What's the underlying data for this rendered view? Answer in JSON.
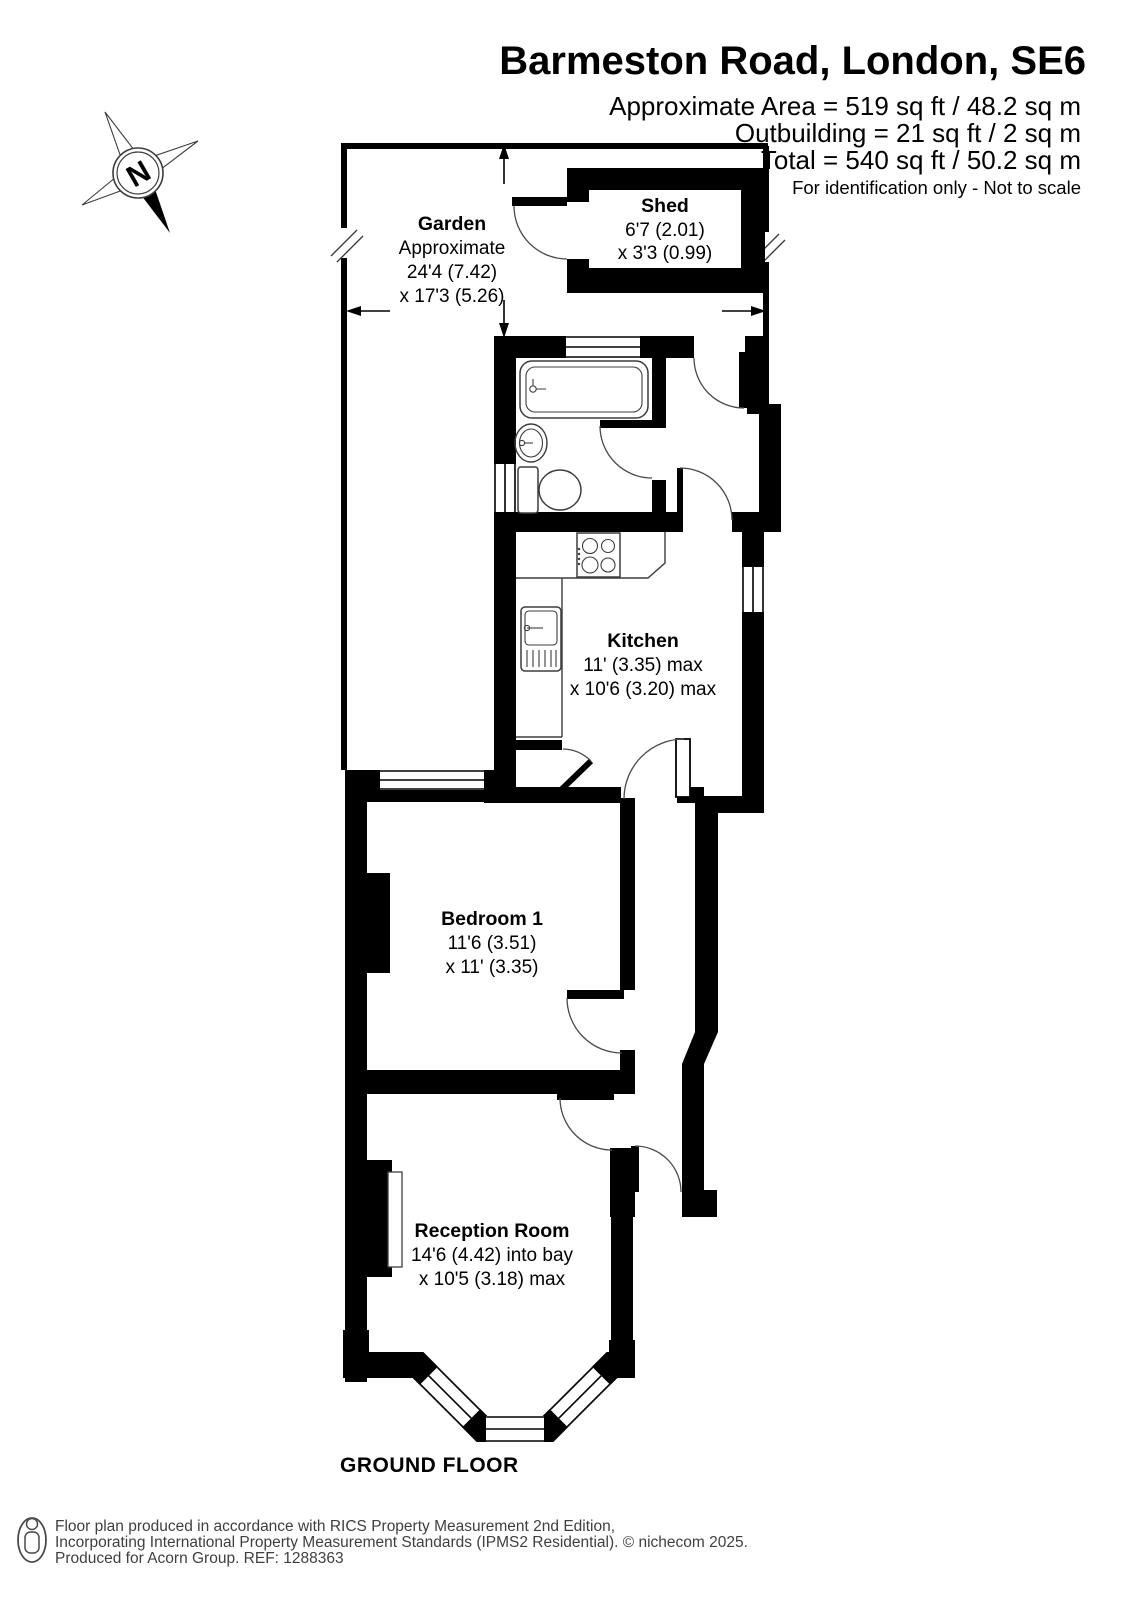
{
  "header": {
    "title": "Barmeston Road, London, SE6",
    "line1": "Approximate Area = 519 sq ft / 48.2 sq m",
    "line2": "Outbuilding = 21 sq ft / 2 sq m",
    "line3": "Total = 540 sq ft / 50.2 sq m",
    "disclaimer": "For identification only - Not to scale"
  },
  "compass": {
    "north_label": "N"
  },
  "rooms": {
    "garden": {
      "name": "Garden",
      "l1": "Approximate",
      "l2": "24'4 (7.42)",
      "l3": "x 17'3 (5.26)"
    },
    "shed": {
      "name": "Shed",
      "l1": "6'7 (2.01)",
      "l2": "x 3'3 (0.99)"
    },
    "kitchen": {
      "name": "Kitchen",
      "l1": "11' (3.35) max",
      "l2": "x 10'6 (3.20) max"
    },
    "bedroom": {
      "name": "Bedroom 1",
      "l1": "11'6 (3.51)",
      "l2": "x 11' (3.35)"
    },
    "reception": {
      "name": "Reception Room",
      "l1": "14'6 (4.42) into bay",
      "l2": "x 10'5 (3.18) max"
    }
  },
  "floor": {
    "label": "GROUND FLOOR"
  },
  "footer": {
    "l1": "Floor plan produced in accordance with RICS Property Measurement 2nd Edition,",
    "l2": "Incorporating International Property Measurement Standards (IPMS2 Residential).   © nichecom 2025.",
    "l3": "Produced for Acorn Group.   REF:  1288363"
  },
  "fixtures": [
    "bathtub",
    "washbasin",
    "toilet",
    "hob",
    "kitchen-sink",
    "kitchen-counter",
    "fireplace",
    "compass-rose",
    "person-pictogram"
  ],
  "colors": {
    "walls": "#000000",
    "thin_lines": "#3d3d3d",
    "background": "#ffffff",
    "footer_text": "#3f3f3f"
  }
}
